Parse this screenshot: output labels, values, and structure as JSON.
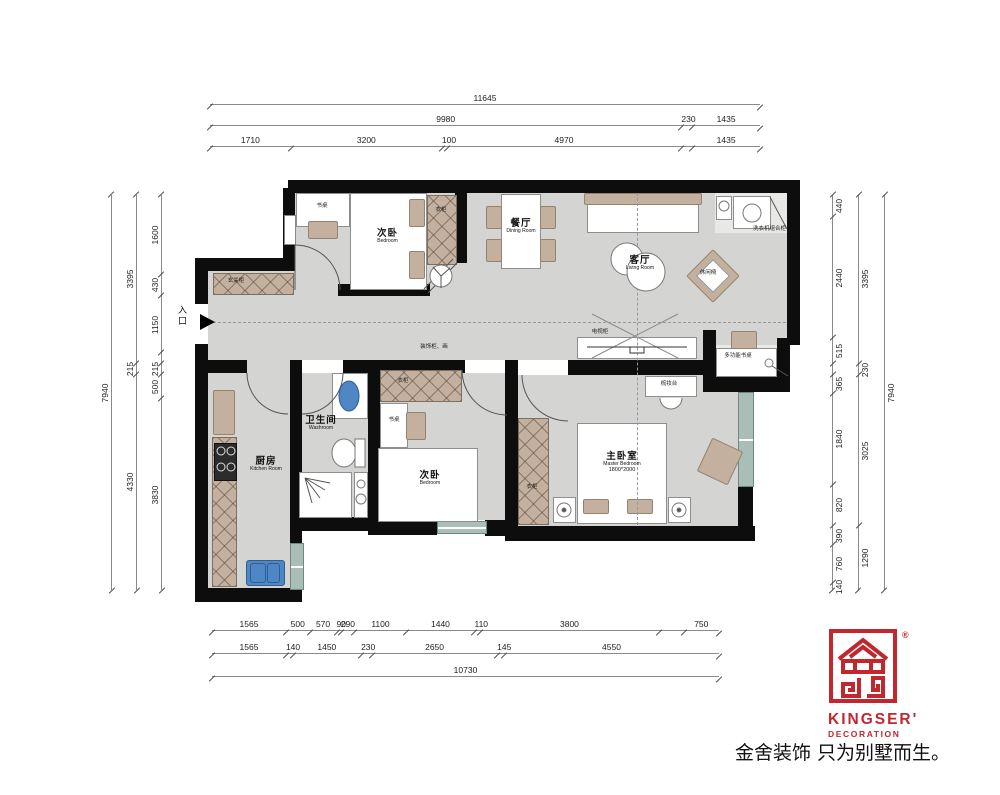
{
  "colors": {
    "red": "#c1272d",
    "wall": "#0d0d0d",
    "floor": "#d4d4d3",
    "window_teal": "#a9beb6",
    "fixture_blue": "#4f86c6",
    "furniture_tan": "#c3b09e"
  },
  "entry": {
    "label": "入口"
  },
  "rooms": {
    "bedroom_top": {
      "cn": "次卧",
      "en": "Bedroom"
    },
    "dining": {
      "cn": "餐厅",
      "en": "Dining Room"
    },
    "living": {
      "cn": "客厅",
      "en": "Living Room"
    },
    "washroom": {
      "cn": "卫生间",
      "en": "Washroom"
    },
    "kitchen": {
      "cn": "厨房",
      "en": "Kitchen Room"
    },
    "bedroom_bottom": {
      "cn": "次卧",
      "en": "Bedroom"
    },
    "master": {
      "cn": "主卧室",
      "en": "Master Bedroom",
      "size": "1800*2000"
    }
  },
  "furniture_labels": {
    "desk1": "书桌",
    "wardrobe1": "衣柜",
    "entry_cabinet": "玄关柜",
    "laundry_cabinet": "洗衣机组合柜",
    "tv_cabinet": "电视柜",
    "dresser": "梳妆台",
    "multi_desk": "多功能书桌",
    "lounge_chair": "休闲椅",
    "desk2": "书桌",
    "wardrobe2": "衣柜",
    "wardrobe_master": "衣柜",
    "hall_note": "装饰柜、画"
  },
  "logo": {
    "brand": "KINGSER'",
    "sub": "DECORATION",
    "reg": "®",
    "tagline": "金舍装饰 只为别墅而生。"
  },
  "dims": {
    "top": [
      [
        {
          "mm": 11645,
          "v": "11645"
        }
      ],
      [
        {
          "mm": 9980,
          "v": "9980"
        },
        {
          "mm": 230,
          "v": "230"
        },
        {
          "mm": 1435,
          "v": "1435"
        }
      ],
      [
        {
          "mm": 1710,
          "v": "1710"
        },
        {
          "mm": 3200,
          "v": "3200"
        },
        {
          "mm": 100,
          "v": "100"
        },
        {
          "mm": 4970,
          "v": "4970"
        },
        {
          "mm": 230,
          "v": ""
        },
        {
          "mm": 1435,
          "v": "1435"
        }
      ]
    ],
    "bottom": [
      [
        {
          "mm": 1565,
          "v": "1565"
        },
        {
          "mm": 500,
          "v": "500"
        },
        {
          "mm": 570,
          "v": "570"
        },
        {
          "mm": 90,
          "v": "90"
        },
        {
          "mm": 290,
          "v": "290"
        },
        {
          "mm": 1100,
          "v": "1100"
        },
        {
          "mm": 1440,
          "v": "1440"
        },
        {
          "mm": 110,
          "v": "110"
        },
        {
          "mm": 3800,
          "v": "3800"
        },
        {
          "mm": 515,
          "v": ""
        },
        {
          "mm": 750,
          "v": "750"
        }
      ],
      [
        {
          "mm": 1565,
          "v": "1565"
        },
        {
          "mm": 140,
          "v": "140"
        },
        {
          "mm": 1450,
          "v": "1450"
        },
        {
          "mm": 230,
          "v": "230"
        },
        {
          "mm": 2650,
          "v": "2650"
        },
        {
          "mm": 145,
          "v": "145"
        },
        {
          "mm": 4550,
          "v": "4550"
        }
      ],
      [
        {
          "mm": 10730,
          "v": "10730"
        }
      ]
    ],
    "left": [
      [
        {
          "mm": 7940,
          "v": "7940"
        }
      ],
      [
        {
          "mm": 3395,
          "v": "3395"
        },
        {
          "mm": 215,
          "v": "215"
        },
        {
          "mm": 4330,
          "v": "4330"
        }
      ],
      [
        {
          "mm": 1600,
          "v": "1600"
        },
        {
          "mm": 430,
          "v": "430"
        },
        {
          "mm": 1150,
          "v": "1150"
        },
        {
          "mm": 215,
          "v": ""
        },
        {
          "mm": 215,
          "v": "215"
        },
        {
          "mm": 500,
          "v": "500"
        },
        {
          "mm": 3830,
          "v": "3830"
        }
      ]
    ],
    "right": [
      [
        {
          "mm": 440,
          "v": "440"
        },
        {
          "mm": 2440,
          "v": "2440"
        },
        {
          "mm": 515,
          "v": "515"
        },
        {
          "mm": 230,
          "v": ""
        },
        {
          "mm": 365,
          "v": "365"
        },
        {
          "mm": 1840,
          "v": "1840"
        },
        {
          "mm": 820,
          "v": "820"
        },
        {
          "mm": 390,
          "v": "390"
        },
        {
          "mm": 760,
          "v": "760"
        },
        {
          "mm": 140,
          "v": "140"
        }
      ],
      [
        {
          "mm": 3395,
          "v": "3395"
        },
        {
          "mm": 230,
          "v": "230"
        },
        {
          "mm": 3025,
          "v": "3025"
        },
        {
          "mm": 1290,
          "v": "1290"
        }
      ],
      [
        {
          "mm": 7940,
          "v": "7940"
        }
      ]
    ]
  }
}
